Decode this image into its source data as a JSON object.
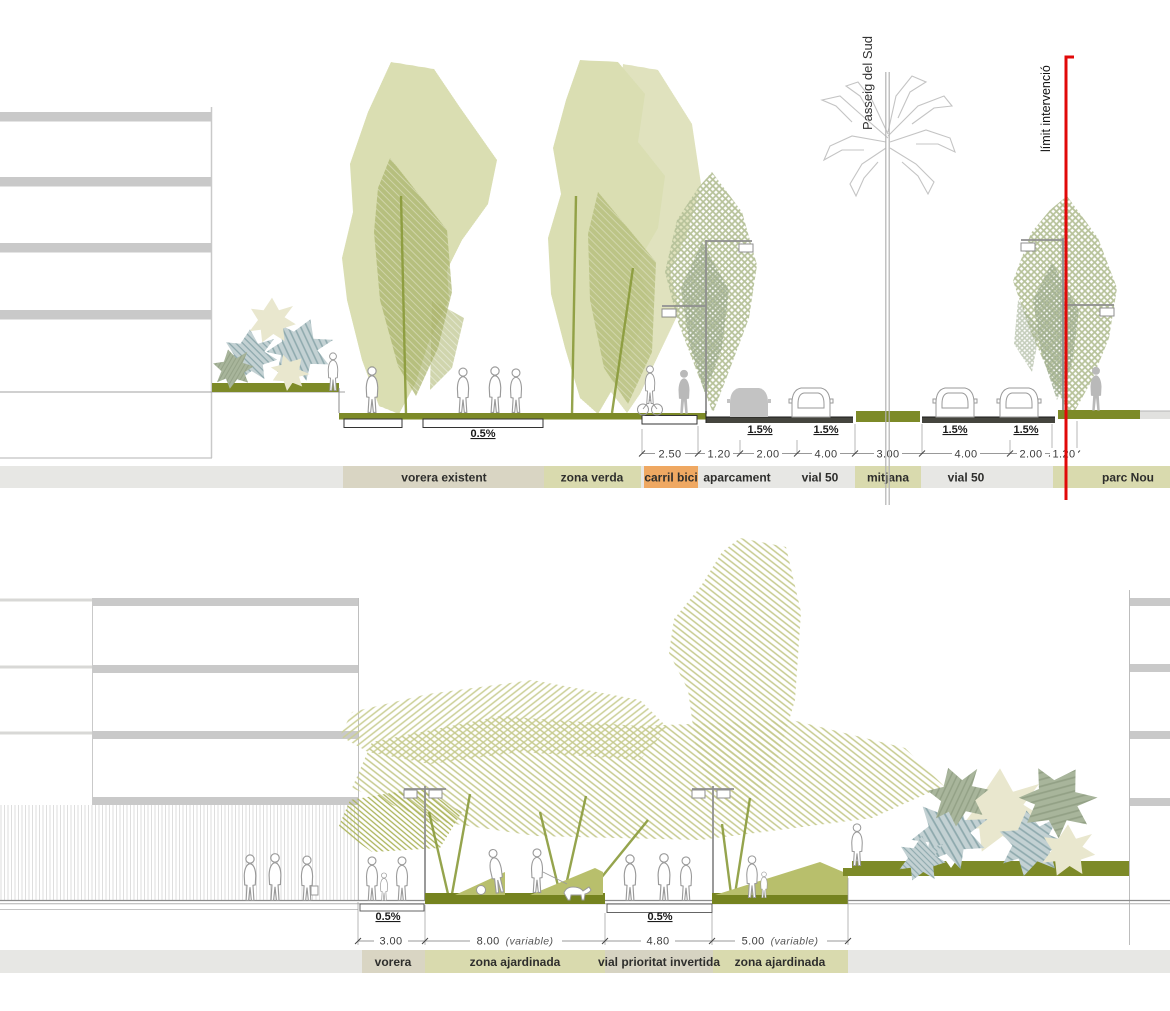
{
  "top_section": {
    "street_name": "Passeig del Sud",
    "limit_label": "límit intervenció",
    "slope_sidewalk_label": "0.5%",
    "slope_road_label": "1.5%",
    "dimensions": [
      "2.50",
      "1.20",
      "2.00",
      "4.00",
      "3.00",
      "4.00",
      "2.00",
      "1.20"
    ],
    "zones": [
      "vorera existent",
      "zona verda",
      "carril bici",
      "aparcament",
      "vial 50",
      "mitjana",
      "vial 50",
      "parc Nou"
    ]
  },
  "bottom_section": {
    "slope_label": "0.5%",
    "dimensions": [
      {
        "value": "3.00",
        "suffix": ""
      },
      {
        "value": "8.00",
        "suffix": "(variable)"
      },
      {
        "value": "4.80",
        "suffix": ""
      },
      {
        "value": "5.00",
        "suffix": "(variable)"
      }
    ],
    "zones": [
      "vorera",
      "zona ajardinada",
      "vial prioritat invertida",
      "zona ajardinada"
    ]
  },
  "colors": {
    "band_background": "#e7e7e4",
    "zone_tan": "#d9d5c3",
    "zone_olive": "#d9daae",
    "zone_orange": "#efa862",
    "ground_olive_dark": "#7d8a28",
    "mound_olive": "#b8bf6c",
    "tree_olive": "#cdd298",
    "limit_red": "#e10909"
  }
}
